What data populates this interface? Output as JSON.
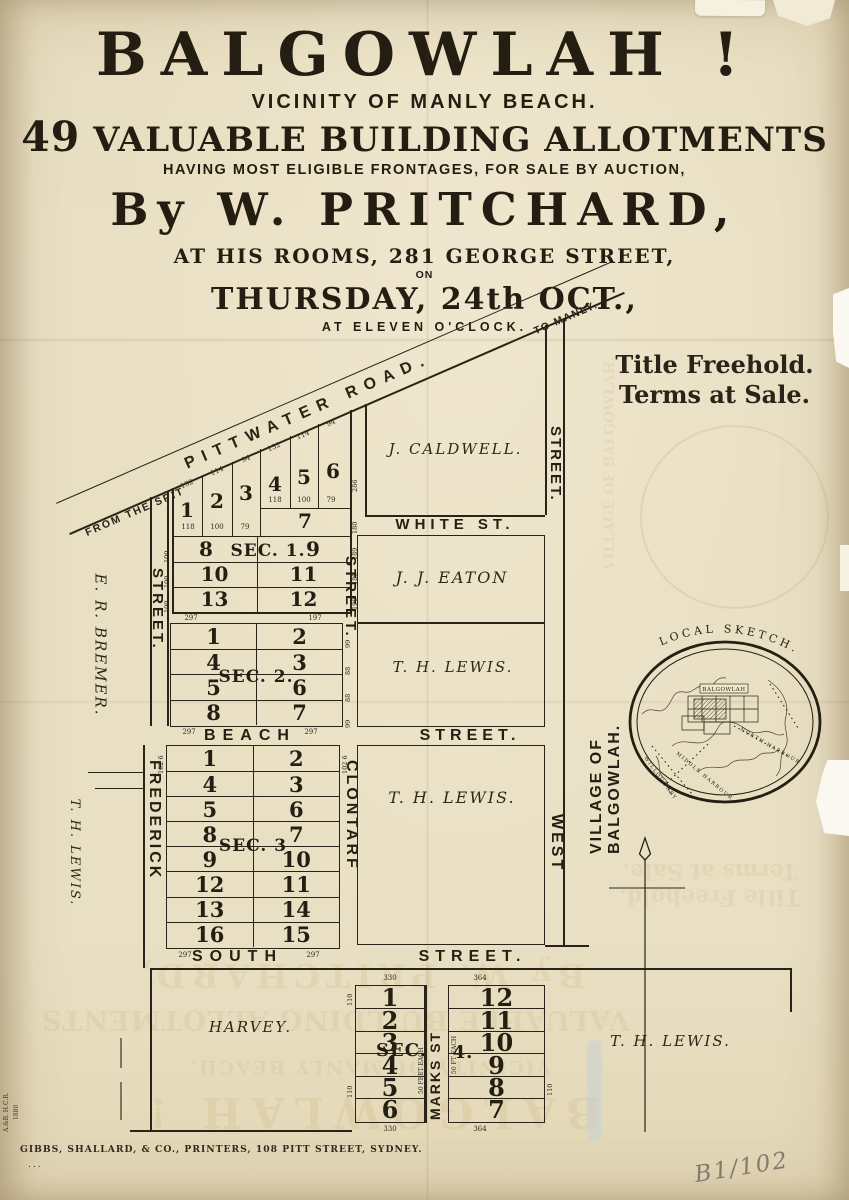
{
  "colors": {
    "paper": "#e9dfc3",
    "ink": "#2a2318",
    "pencil": "#827c6e",
    "bleed": "#b5974e"
  },
  "header": {
    "title": "BALGOWLAH !",
    "subtitle": "VICINITY OF MANLY BEACH.",
    "line3_num": "49",
    "line3_text": "VALUABLE BUILDING ALLOTMENTS",
    "line4": "HAVING MOST ELIGIBLE FRONTAGES, FOR SALE BY AUCTION,",
    "by": "By W. PRITCHARD,",
    "rooms": "AT HIS ROOMS, 281 GEORGE STREET,",
    "on": "ON",
    "date": "THURSDAY, 24th OCT.,",
    "time": "AT ELEVEN O'CLOCK."
  },
  "terms": {
    "line1": "Title Freehold.",
    "line2": "Terms at Sale."
  },
  "road": {
    "from": "FROM THE SPIT",
    "name": "PITTWATER ROAD.",
    "to": "TO MANLY."
  },
  "streets": {
    "white": "WHITE ST.",
    "beach": "BEACH",
    "beach2": "STREET.",
    "south": "SOUTH",
    "south2": "STREET.",
    "left_street": "STREET.",
    "frederick": "FREDERICK",
    "clontarf_n": "STREET.",
    "clontarf": "CLONTARF",
    "west_n": "STREET.",
    "west": "WEST",
    "marks": "MARKS ST"
  },
  "owners": {
    "caldwell": "J. CALDWELL.",
    "eaton": "J. J. EATON",
    "lewis": "T. H. LEWIS.",
    "bremer": "E. R. BREMER.",
    "harvey": "HARVEY."
  },
  "sections": {
    "sec1": {
      "label": "SEC. 1.",
      "lots": {
        "l1": "1",
        "l2": "2",
        "l3": "3",
        "l4": "4",
        "l5": "5",
        "l6": "6",
        "l7": "7",
        "l8": "8",
        "l9": "9",
        "l10": "10",
        "l11": "11",
        "l12": "12",
        "l13": "13"
      },
      "top_measures": [
        "132",
        "114",
        "94",
        "132",
        "114",
        "94"
      ],
      "base_measures": [
        "118",
        "100",
        "79",
        "118",
        "100",
        "79"
      ],
      "left_measures": [
        "100",
        "100",
        "100"
      ],
      "right_measures": [
        "180",
        "189",
        "189",
        "190"
      ],
      "right_measure": "286",
      "bottom_measures": [
        "297",
        "197"
      ]
    },
    "sec2": {
      "label": "SEC. 2.",
      "rows": [
        [
          "1",
          "2"
        ],
        [
          "4",
          "3"
        ],
        [
          "5",
          "6"
        ],
        [
          "8",
          "7"
        ]
      ],
      "right_measures": [
        "99",
        "88",
        "88",
        "99"
      ],
      "bottom_measures": [
        "297",
        "297"
      ]
    },
    "sec3": {
      "label": "SEC. 3",
      "rows": [
        [
          "1",
          "2"
        ],
        [
          "4",
          "3"
        ],
        [
          "5",
          "6"
        ],
        [
          "8",
          "7"
        ],
        [
          "9",
          "10"
        ],
        [
          "12",
          "11"
        ],
        [
          "13",
          "14"
        ],
        [
          "16",
          "15"
        ]
      ],
      "corner_measure": "102 6",
      "bottom_measures": [
        "297",
        "297"
      ]
    },
    "sec4": {
      "label_a": "SEC.",
      "label_b": "4.",
      "left_col": [
        "1",
        "2",
        "3",
        "4",
        "5",
        "6"
      ],
      "right_col": [
        "12",
        "11",
        "10",
        "9",
        "8",
        "7"
      ],
      "top_measures": [
        "330",
        "364"
      ],
      "bottom_measures": [
        "330",
        "364"
      ],
      "side_measure": "110",
      "left_note": "50 FEET EACH",
      "right_note": "50 FT EACH"
    }
  },
  "sketch": {
    "title": "LOCAL SKETCH.",
    "village": "VILLAGE OF BALGOWLAH.",
    "town": "BALGOWLAH",
    "north_harbour": "NORTH HARBOUR",
    "middle_harbour": "MIDDLE HARBOUR",
    "willoughby": "WILLOUGHBY"
  },
  "footer": {
    "printer": "GIBBS, SHALLARD, & CO., PRINTERS, 108 PITT STREET, SYDNEY.",
    "dots": "...",
    "mark": "B1/102",
    "margin_note": "A.&B. H.C.R.",
    "margin_year": "1880"
  }
}
